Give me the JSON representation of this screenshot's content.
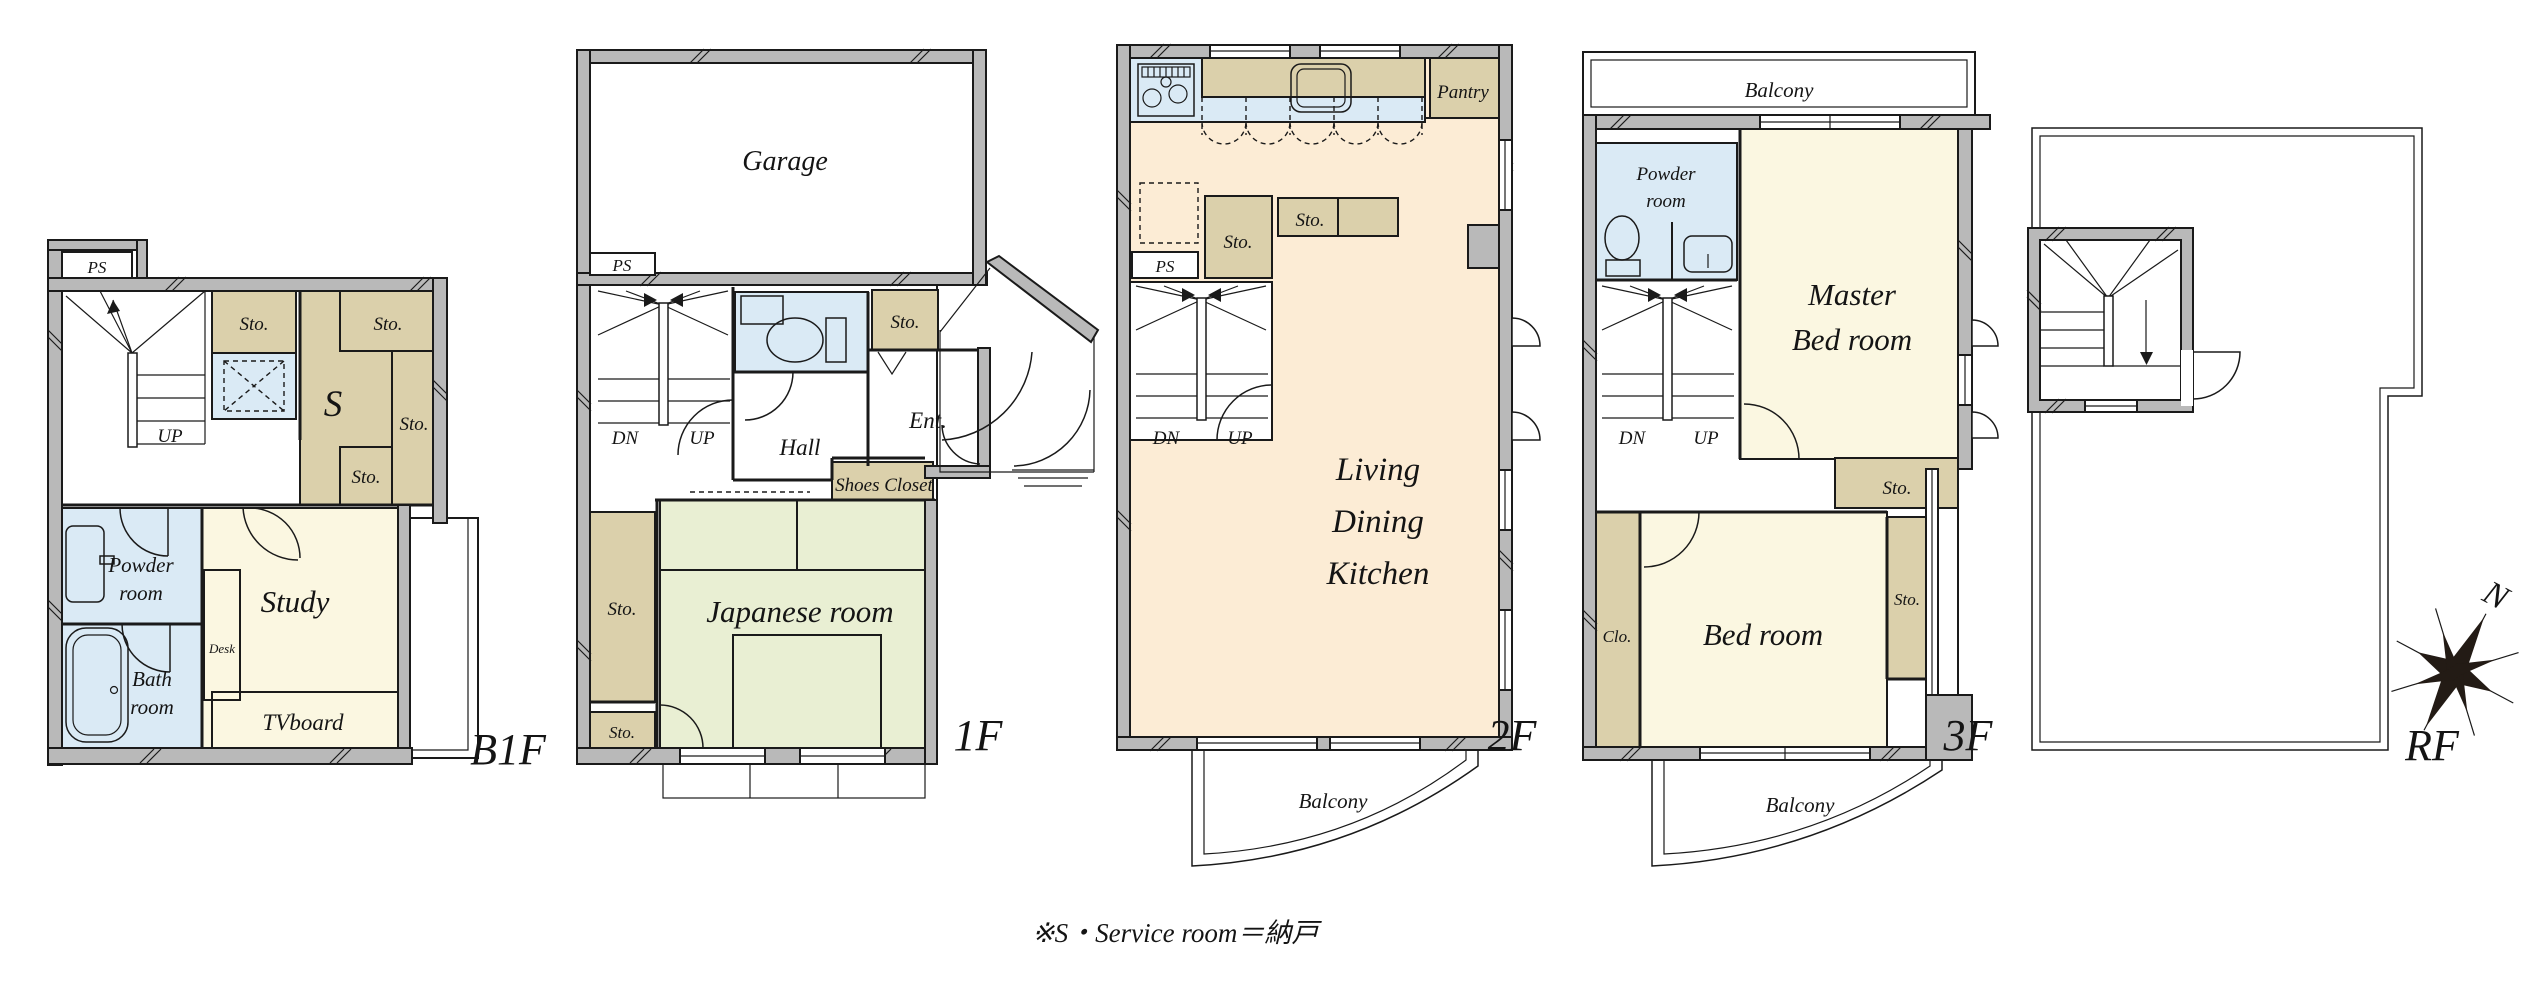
{
  "labels": {
    "sto": "Sto.",
    "ps": "PS",
    "dn": "DN",
    "up": "UP",
    "balcony": "Balcony",
    "desk": "Desk",
    "tvboard": "TVboard",
    "clo": "Clo.",
    "pantry": "Pantry",
    "service": "S",
    "garage": "Garage",
    "hall": "Hall",
    "ent": "Ent.",
    "shoes_closet": "Shoes Closet",
    "japanese_room": "Japanese room",
    "study": "Study",
    "bed_room": "Bed room",
    "powder": [
      "Powder",
      "room"
    ],
    "bath": [
      "Bath",
      "room"
    ],
    "master": [
      "Master",
      "Bed room"
    ],
    "ldk": [
      "Living",
      "Dining",
      "Kitchen"
    ]
  },
  "floors": {
    "b1f": "B1F",
    "f1": "1F",
    "f2": "2F",
    "f3": "3F",
    "rf": "RF"
  },
  "compass": {
    "north": "N"
  },
  "note": "※S・Service room＝納戸",
  "colors": {
    "wall_gray": "#b9b9b9",
    "room_cream": "#fbf7e1",
    "ldk_peach": "#fcecd5",
    "tatami_green": "#e9efd3",
    "storage_tan": "#dbd0ab",
    "wet_area_blue": "#daeaf5",
    "line": "#1a1a1a",
    "background": "#ffffff"
  }
}
